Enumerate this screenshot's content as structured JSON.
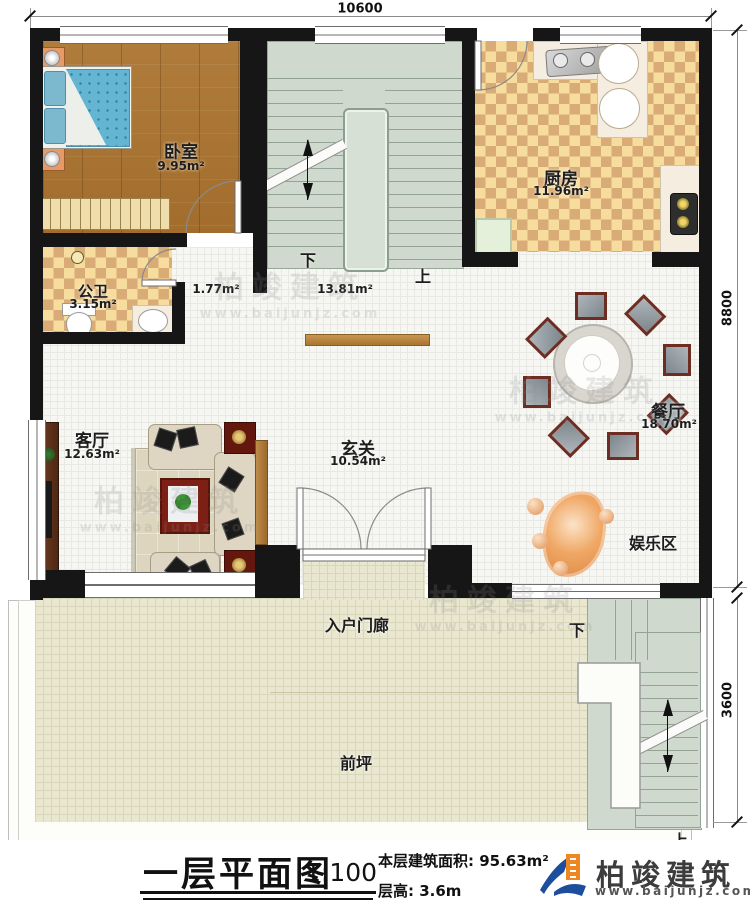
{
  "dimensions": {
    "top": "10600",
    "right_upper": "8800",
    "right_lower": "3600"
  },
  "rooms": {
    "bedroom": {
      "name": "卧室",
      "area": "9.95m²"
    },
    "bathroom": {
      "name": "公卫",
      "area": "3.15m²"
    },
    "kitchen": {
      "name": "厨房",
      "area": "11.96m²"
    },
    "dining": {
      "name": "餐厅",
      "area": "18.70m²"
    },
    "living": {
      "name": "客厅",
      "area": "12.63m²"
    },
    "hall": {
      "name": "玄关",
      "area": "10.54m²"
    },
    "entertainment": {
      "name": "娱乐区"
    },
    "porch": {
      "name": "入户门廊"
    },
    "front_yard": {
      "name": "前坪"
    }
  },
  "stairs": {
    "interior": {
      "down_label": "下",
      "up_label": "上",
      "corridor_area": "1.77m²",
      "stair_area": "13.81m²"
    },
    "exterior": {
      "down_label": "下",
      "up_label": "上"
    }
  },
  "watermark": {
    "brand": "柏竣建筑",
    "website": "www.baijunjz.com"
  },
  "footer": {
    "plan_title": "一层平面图",
    "scale": "1:100",
    "area_note": "本层建筑面积: 95.63m²",
    "floor_height": "层高: 3.6m",
    "brand": "柏竣建筑",
    "website": "www.baijunjz.com"
  },
  "palette": {
    "wall": "#161616",
    "brand_blue": "#1d4e9e",
    "brand_orange": "#ee8722"
  }
}
